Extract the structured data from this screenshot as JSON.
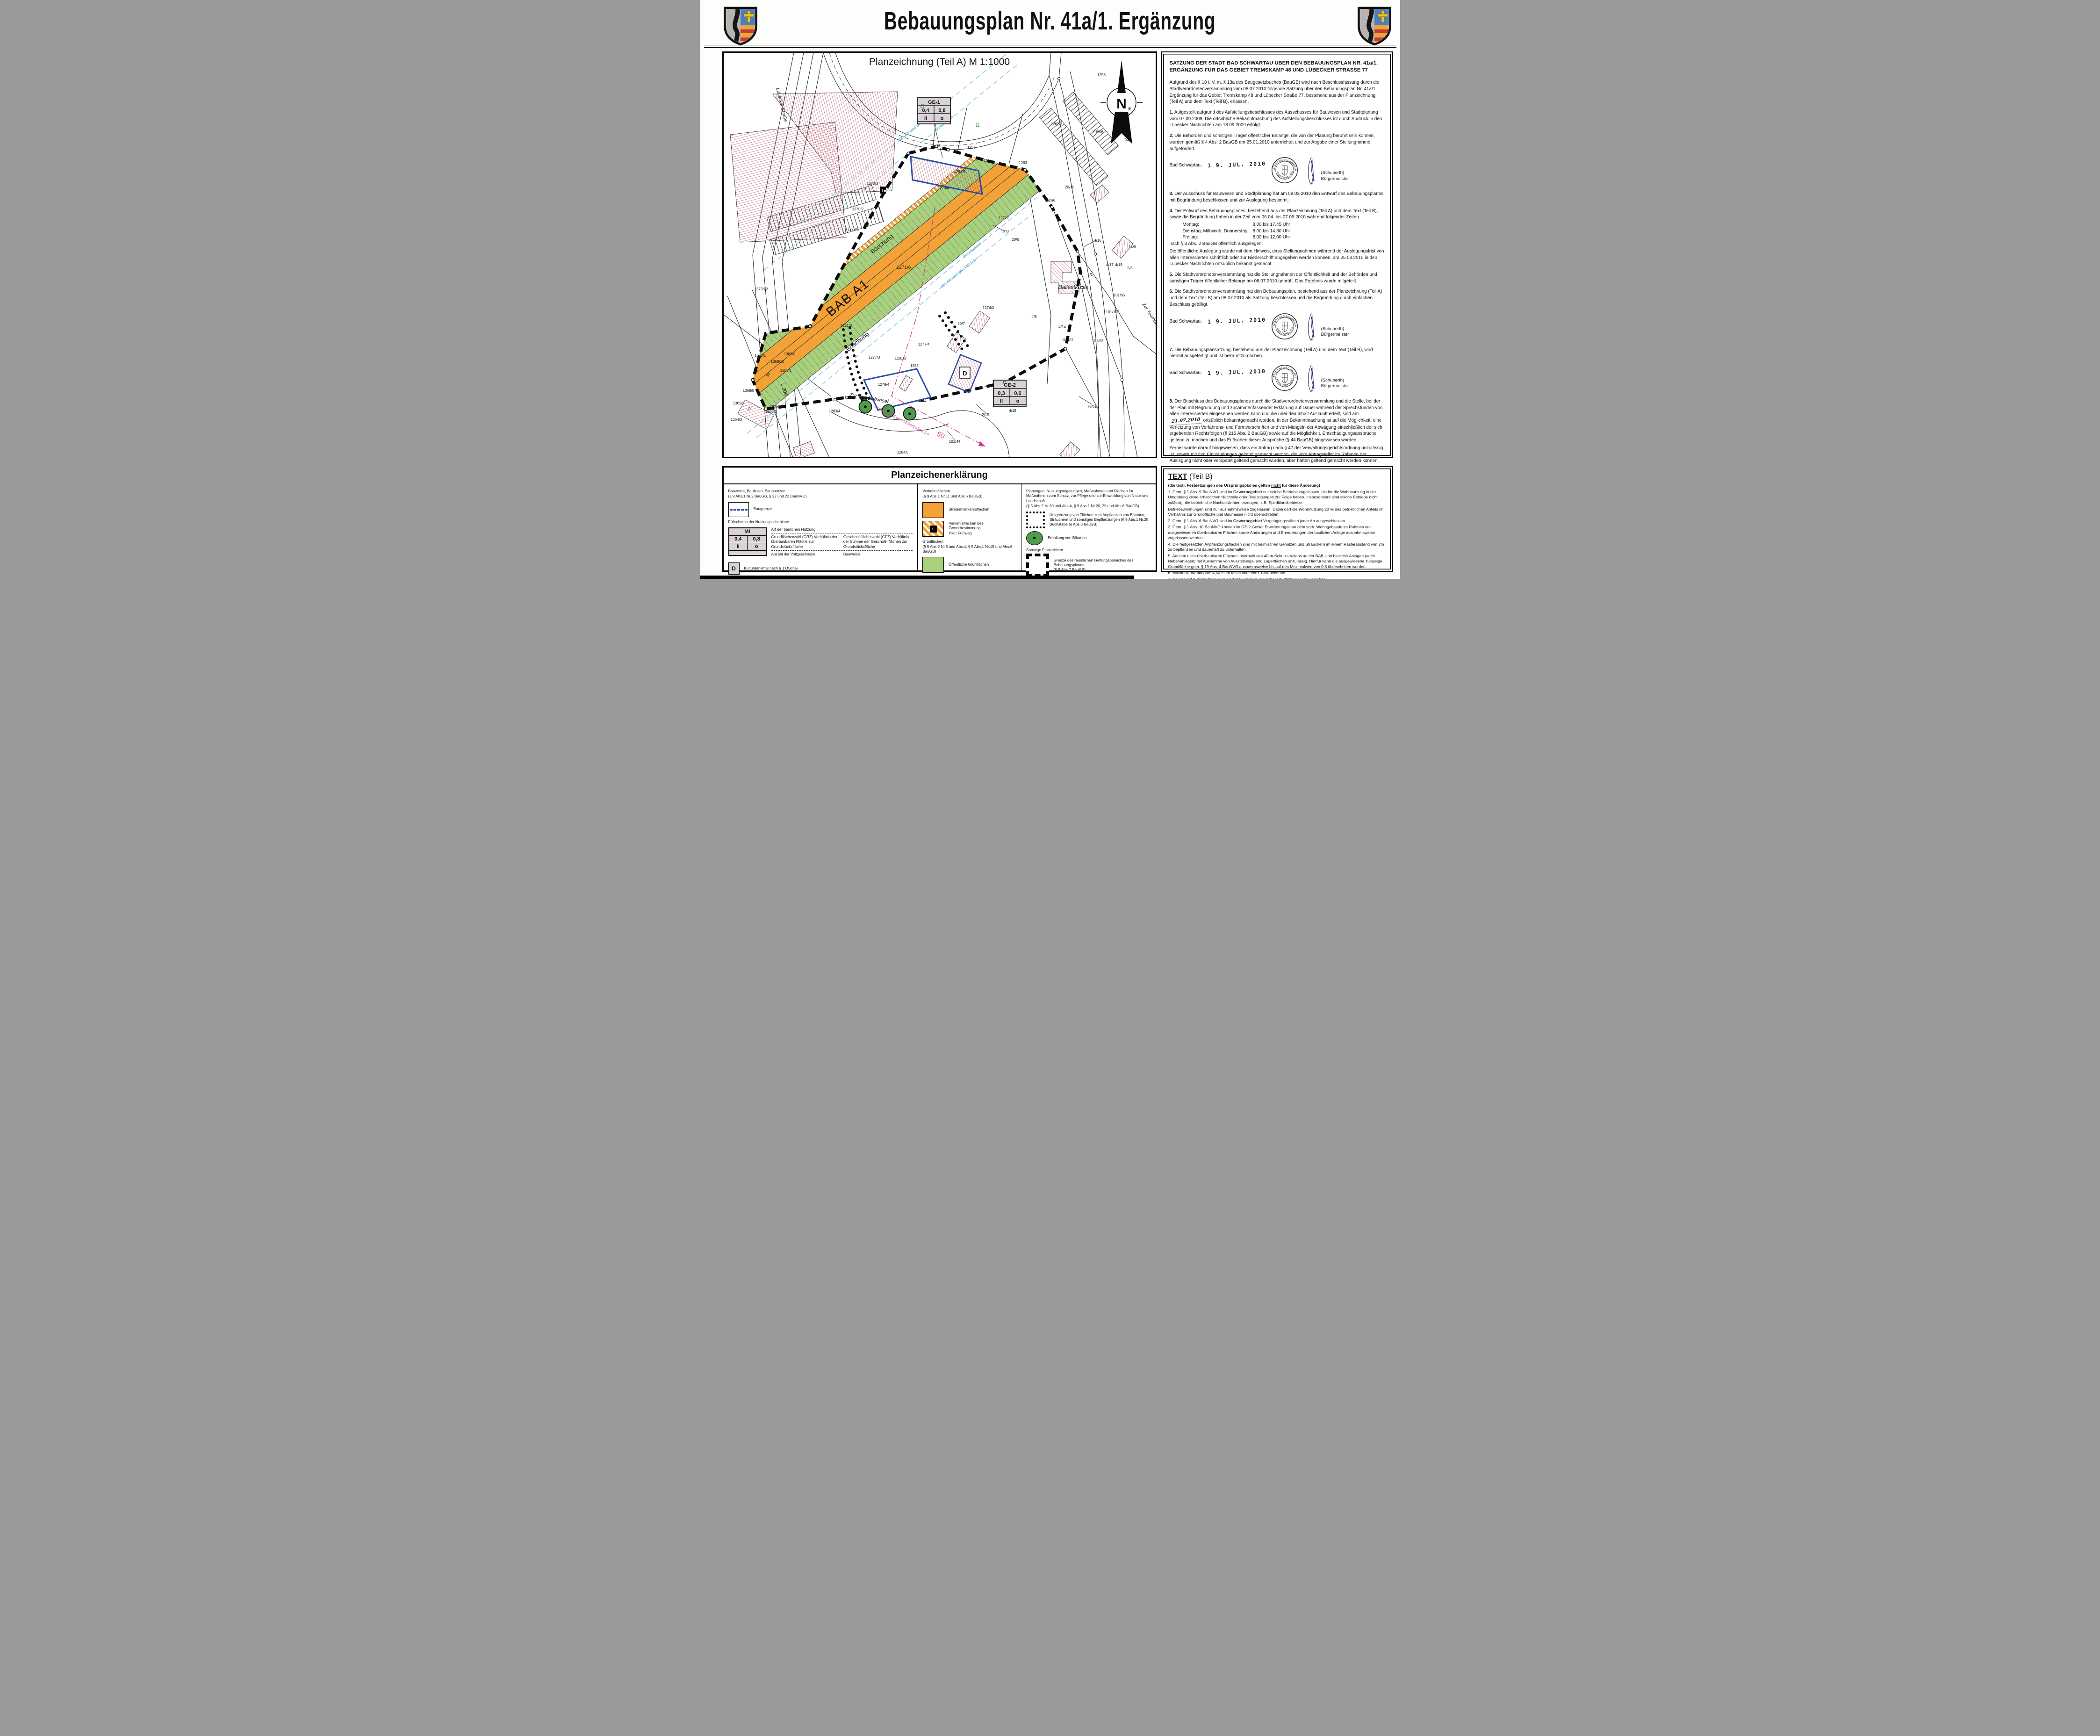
{
  "page": {
    "title": "Bebauungsplan Nr. 41a/1. Ergänzung"
  },
  "map": {
    "title": "Planzeichnung (Teil A) M 1:1000",
    "north": "N",
    "big": {
      "bab": "BAB A1",
      "boe1": "Böschung",
      "boe2": "Böschung"
    },
    "streets": {
      "luebecker": "Lübecker Straße",
      "teerhof": "Zur Teerhofsinsel",
      "teerhof2": "Zur Teerhofsinsel",
      "l309": "L 309",
      "ballast": "Ballastkuhle"
    },
    "abstand": {
      "a40ne": "40m-Abstand gem FStrG § 9",
      "a30ne": "30m Abstand",
      "a30se": "30m-Abstand",
      "a40se": "40m-Abstand gem FStrG § 9",
      "a50": "50-m-Abstand gem LEisenbahnG § 6",
      "fifty": "50"
    },
    "ge1": {
      "name": "GE-1",
      "grz": "0,4",
      "gfz": "0,8",
      "st": "II",
      "bw": "o"
    },
    "ge2": {
      "name": "GE-2",
      "grz": "0,3",
      "gfz": "0,6",
      "st": "II",
      "bw": "o"
    },
    "denkmal": "D",
    "fussweg_icon": "t.",
    "omega1": "Ω",
    "omega2": "Ω",
    "parcels": [
      "1258",
      "1259",
      "1262/3",
      "1189/6",
      "7/2",
      "1263",
      "1267",
      "1266",
      "20/10",
      "1268/6",
      "1270/4",
      "1270/3",
      "1270/2",
      "1270/1",
      "1271/1",
      "1272",
      "20/6",
      "1271/6",
      "1373/12",
      "1271/3",
      "1274/3",
      "1370/1",
      "1279/4",
      "1277/4",
      "1277/3",
      "1281/3",
      "1282",
      "20/7",
      "4/19",
      "4/16",
      "14/8",
      "4/17",
      "4/18",
      "5/3",
      "4/1",
      "101/95",
      "101/105",
      "4/9",
      "4/14",
      "101/87",
      "101/93",
      "2/15",
      "101/44",
      "78/61",
      "1284/5",
      "1283/4",
      "1368/9",
      "1368/10",
      "1368/1",
      "1368/5",
      "1368/2",
      "1365/2",
      "1365/1",
      "1364/3",
      "59",
      "55"
    ]
  },
  "satzung": {
    "heading": "SATZUNG DER STADT BAD SCHWARTAU ÜBER DEN BEBAUUNGSPLAN NR. 41a/1. ERGÄNZUNG FÜR DAS GEBIET TREMSKAMP 48 UND LÜBECKER STRASSE 77",
    "intro": "Aufgrund des § 10 i. V. m. § 13a des Baugesetzbuches (BauGB) wird nach Beschlussfassung durch die Stadtverordnetenversammlung vom 08.07.2010 folgende Satzung über den Bebauungsplan Nr. 41a/1. Ergänzung für das Gebiet Tremskamp 48 und Lübecker Straße 77, bestehend aus der Planzeichnung (Teil A) und dem Text (Teil B), erlassen.",
    "p1n": "1.",
    "p1": " Aufgestellt aufgrund des Aufstellungsbeschlusses des Ausschusses für Bauwesen und Stadtplanung vom 07.09.2009. Die ortsübliche Bekanntmachung des Aufstellungsbeschlusses ist durch Abdruck in den Lübecker Nachrichten am 18.09.2009 erfolgt.",
    "p2n": "2.",
    "p2": " Die Behörden und sonstigen Träger öffentlicher Belange, die von der Planung berührt sein können, wurden gemäß § 4 Abs. 2 BauGB am 25.01.2010 unterrichtet und zur Abgabe einer Stellungnahme aufgefordert.",
    "p3n": "3.",
    "p3": " Der Ausschuss für Bauwesen und Stadtplanung hat am 08.03.2010 den Entwurf des Bebauungsplanes mit Begründung beschlossen und zur Auslegung bestimmt.",
    "p4n": "4.",
    "p4a": " Der Entwurf des Bebauungsplanes, bestehend aus der Planzeichnung (Teil A) und dem Text (Teil B), sowie die Begründung haben in der Zeit vom  06.04. bis 07.05.2010 während folgender Zeiten",
    "sched": [
      {
        "d": "Montag:",
        "t": "8.00 bis 17.45 Uhr"
      },
      {
        "d": "Dienstag, Mittwoch, Donnerstag:",
        "t": "8.00 bis 14.30 Uhr"
      },
      {
        "d": "Freitag:",
        "t": "8.00 bis 12.00 Uhr"
      }
    ],
    "p4b": "nach § 3 Abs. 2 BauGB öffentlich ausgelegen.",
    "p4c": "Die öffentliche Auslegung wurde mit dem Hinweis, dass  Stellungnahmen während der Auslegungsfrist von allen Interessierten schriftlich oder zur Niederschrift abgegeben werden können, am 25.03.2010 in den Lübecker Nachrichten ortsüblich bekannt gemacht.",
    "p5n": "5.",
    "p5": " Die Stadtverordnetenversammlung hat die Stellungnahmen der Öffentlichkeit und der Behörden und sonstigen Träger öffentlicher Belange am 08.07.2010 geprüft. Das Ergebnis wurde mitgeteilt.",
    "p6n": "6.",
    "p6": " Die Stadtverordnetenversammlung hat den Bebauungsplan, bestehend aus der Planzeichnung (Teil A) und dem Text (Teil B) am 08.07.2010 als Satzung beschlossen und die Begründung durch einfachen Beschluss gebilligt.",
    "p7n": "7.",
    "p7": " Die Bebauungsplansatzung, bestehend aus der Planzeichnung (Teil A) und dem Text (Teil B), wird hiermit ausgefertigt und ist bekanntzumachen.",
    "p8n": "8.",
    "p8a": " Der Beschluss des Bebauungsplanes durch die Stadtverordnetenversammlung und die Stelle, bei der der Plan mit Begründung und zusammenfassender Erklärung auf Dauer während der Sprechstunden von allen Interessierten eingesehen werden kann und die über den Inhalt Auskunft erteilt, sind am ",
    "p8date": "21.07.2010",
    "p8b": " ortsüblich bekanntgemacht worden. In der Bekanntmachung ist auf die Möglichkeit, eine Verletzung von Verfahrens- und Formvorschriften und von Mängeln der Abwägung einschließlich der sich ergebenden Rechtsfolgen (§ 215 Abs. 2 BauGB) sowie auf die Möglichkeit, Entschädigungsansprüche geltend zu machen und das Erlöschen dieser Ansprüche (§ 44 BauGB) hingewiesen worden.",
    "p8c": "Ferner wurde darauf hingewiesen, dass ein Antrag nach § 47 der Verwaltungsgerichtsordnung unzulässig ist, soweit mit ihm Einwendungen geltend gemacht werden, die vom Antragsteller im Rahmen der Auslegung nicht oder verspätet geltend gemacht wurden, aber hätten geltend gemacht werden können.",
    "p8d": "Auf die Rechtswirkungen des § 4 Abs. 3 GO wurde ebenfalls hingewiesen.",
    "inkraft_a": "Die Satzung ist am ",
    "inkraft_date": "22.07.2010",
    "inkraft_b": " in Kraft getreten.",
    "sign_common": {
      "place": "Bad Schwartau,",
      "name": "(Schuberth)",
      "role": "Bürgermeister",
      "seal_top": "STADT BAD SCHWARTAU",
      "seal_bottom": "KREIS OSTHOLSTEIN"
    },
    "signs": [
      {
        "date": "1 9. JUL. 2010"
      },
      {
        "date": "1 9. JUL. 2010"
      },
      {
        "date": "1 9. JUL. 2010"
      },
      {
        "date": "2 2. JUL. 2010"
      }
    ]
  },
  "legend": {
    "title": "Planzeichenerklärung",
    "col1": {
      "h": "Bauweise, Baulinien, Baugrenzen",
      "hs": "(§ 9 Abs.1 Nr.2 BauGB, § 22 und 23 BauNVO)",
      "baugrenze": "Baugrenze",
      "fuell": "Füllschema der Nutzungsschablone",
      "art": "Art der baulichen Nutzung",
      "grz1": "Grundflächenzahl (GRZ)",
      "grz2": "Verhältnis der überbaubaren Fläche zur Grundstücksfläche",
      "gfz1": "Geschossflächenzahl (GFZ)",
      "gfz2": "Verhältnis der Summe der Geschoß- flächen zur Grundstücksfläche",
      "voll": "Anzahl der Vollgeschosse",
      "bauweise": "Bauweise",
      "mi": "MI",
      "grz": "0,4",
      "gfz": "0,8",
      "st": "II",
      "bw": "o",
      "d": "D",
      "denkmal": "Kulturdenkmal nach § 1 DSchG"
    },
    "col2": {
      "h": "Verkehrsflächen",
      "hs": "(§ 9 Abs.1 Nr.11 und Abs.6 BauGB)",
      "strasse": "Straßenverkehrsflächen",
      "zweck1": "Verkehrsflächen bes. Zweckbestimmung",
      "zweck2": "Hier: Fußweg",
      "icon": "t.",
      "gruen": "Grünflächen",
      "gruens": "(§ 5 Abs.2 Nr.5 und  Abs.4, § 9 Abs.1 Nr.15 und Abs.6 BauGB)",
      "oeff": "Öffentliche Grünflächen"
    },
    "col3": {
      "h": "Planungen, Nutzungsregelungen, Maßnahmen und Flächen für Maßnahmen zum Schutz, zur Pflege und zur Entwicklung von Natur und Landschaft",
      "hs": "(§ 5 Abs.2 Nr.10 und Abs.4, § 9 Abs.1 Nr.20, 25 und Abs.6  BauGB)",
      "umgr1": "Umgrenzung von Flächen zum Anpflanzen von Bäumen, Sträuchern und sonstigen Bepflanzungen",
      "umgr2": "(§ 9 Abs.1 Nr.25 Buchstabe a) Abs.6  BauGB)",
      "erhalt": "Erhaltung von Bäumen",
      "sonst": "Sonstige Planzeichen",
      "grenze1": "Grenze des räumlichen Geltungsbereiches des Bebauungsplanes",
      "grenze2": "(§ 9 Abs.7 BauGB)"
    }
  },
  "textb": {
    "t1": "TEXT",
    "t2": " (Teil B)",
    "note_a": "(die textl. Festsetzungen des Ursprungsplanes gelten ",
    "note_u": "nicht",
    "note_b": " für diese Änderung)",
    "i1a": "1. Gem. § 1 Abs. 9 BauNVO sind  im ",
    "i1b": "Gewerbegebiet",
    "i1c": " nur solche Betriebe zugelassen, die für die Wohnnutzung in der Umgebung keine erheblichen Nachteile oder Belästigungen zur Folge haben. Insbesondere sind solche Betriebe nicht zulässig, die betriebliche Nachtaktiviäten erzeugen, z.B. Speditionsbetriebe.",
    "i1d": "Betriebswohnungen sind nur ausnahmsweise zugelassen. Dabei darf die Wohnnutzung 20 % des betrieblichen Anteils im Verhältnis zur Grundfläche und Baumasse nicht überschreiten.",
    "i2a": "2. Gem. § 1 Abs. 6 BauNVO sind im ",
    "i2b": "Gewerbegebiet",
    "i2c": " Vergnügungsstätten jeder Art ausgeschlossen.",
    "i3": "3. Gem. § 1 Abs. 10 BauNVO können im GE-2 Gebiet Erweiterungen an dem vorh. Wohngebäude im Rahmen der ausgewiesenen überbaubaren Flächen sowie Änderungen und Erneuerungen der baulichen Anlage ausnahmsweise zugelassen werden.",
    "i4": "4. Die festgesetzten Anpflanzungsflächen sind mit heimischen Gehölzen und Sträuchern im einem Rasterabstand von 2m zu bepflanzen und dauerhaft zu unterhalten.",
    "i5": "5. Auf den nicht-überbaubaren Flächen innerhalb des 40-m-Schutzstreifens an der BAB sind bauliche Anlagen (auch Nebenanlagen) mit Ausnahme von Ausstellungs- und Lagerflächen unzulässig. Hierfür kann die ausgewiesene zulässige Grundfläche gem. § 19 Abs. 4 BauNVO ausnahmsweise bis auf den Maximalwert von 0,8 überschritten werden.",
    "i6": "6. Maximale Wandhöhe: 4,50 m im Mittel über vorh. Geländehöhe",
    "i7": "7. Räume mit Aufenhaltsräumen sind mit Fenstern der Schallschutzklasse 2 zu versehen."
  }
}
